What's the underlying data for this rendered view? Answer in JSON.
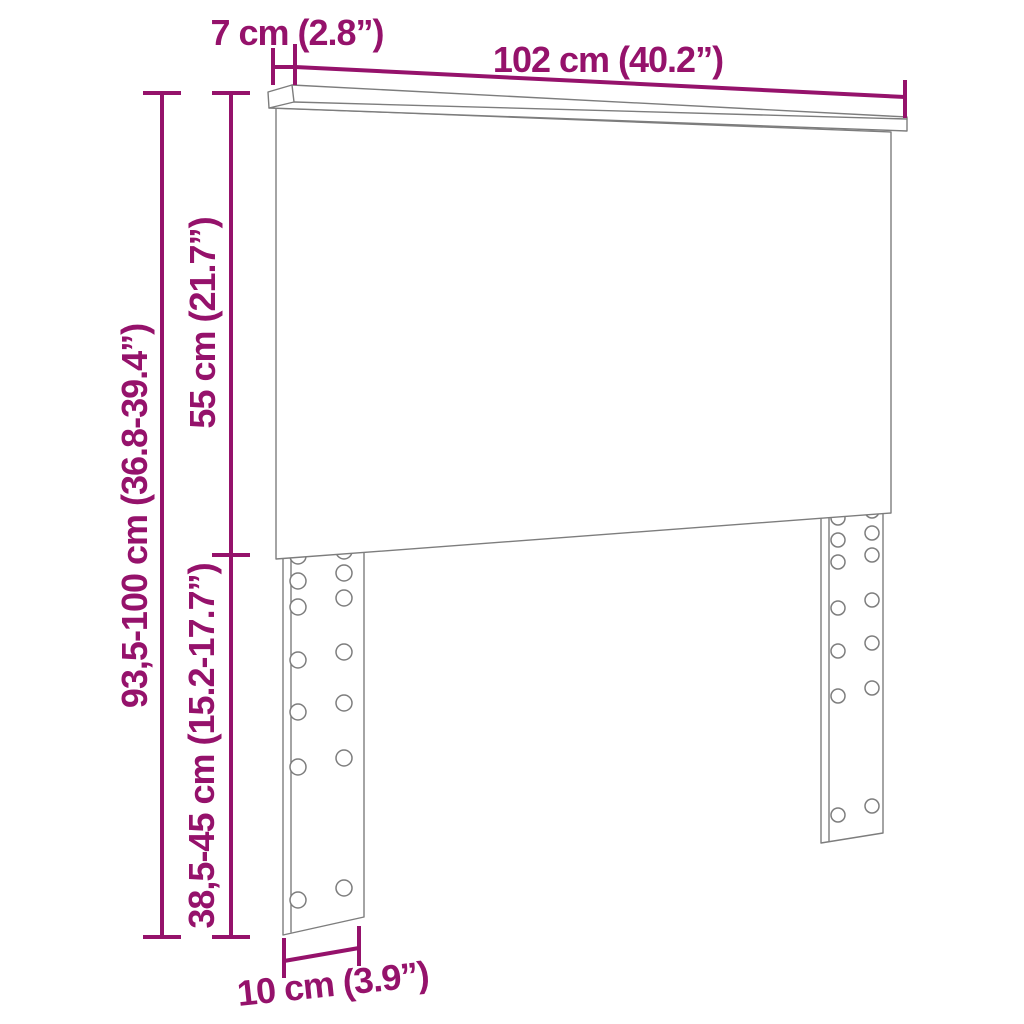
{
  "diagram": {
    "type": "furniture-dimension-diagram",
    "subject": "headboard with two adjustable slotted legs",
    "dimensions": {
      "width": "102 cm (40.2”)",
      "depth": "7 cm (2.8”)",
      "total_height": "93,5-100 cm (36.8-39.4”)",
      "panel_height": "55 cm (21.7”)",
      "leg_height": "38,5-45 cm (15.2-17.7”)",
      "leg_width": "10 cm (3.9”)"
    },
    "colors": {
      "dimension_accent": "#95126B",
      "outline": "#7d7d7d",
      "background": "#ffffff"
    }
  }
}
